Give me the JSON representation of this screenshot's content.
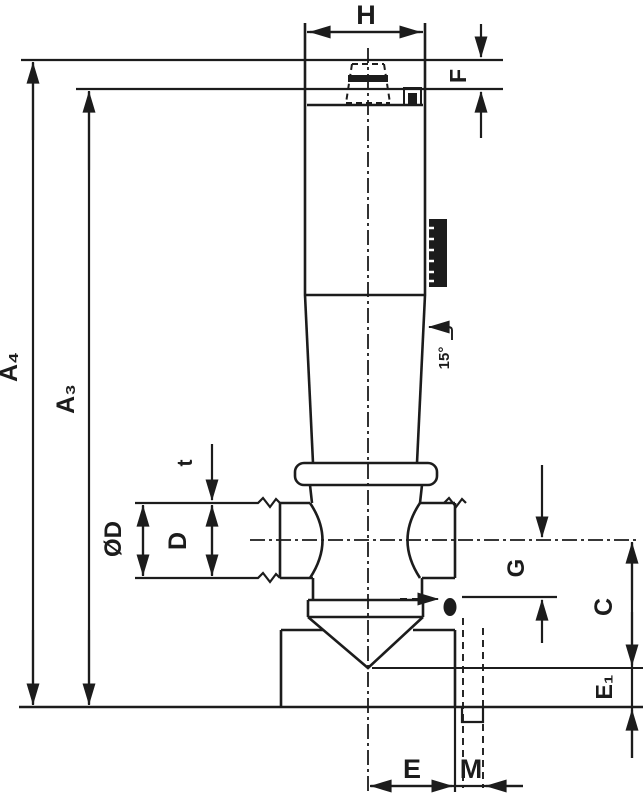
{
  "drawing": {
    "title": "dimensioned clamping-pin technical drawing",
    "colors": {
      "line": "#1c1c1c",
      "background": "#ffffff"
    },
    "dimensions": {
      "h": "H",
      "f": "F",
      "a4": "A₄",
      "a3": "A₃",
      "t": "t",
      "od": "ØD",
      "d": "D",
      "g": "G",
      "c": "C",
      "e1": "E₁",
      "e": "E",
      "m": "M",
      "angle": "15°"
    }
  }
}
